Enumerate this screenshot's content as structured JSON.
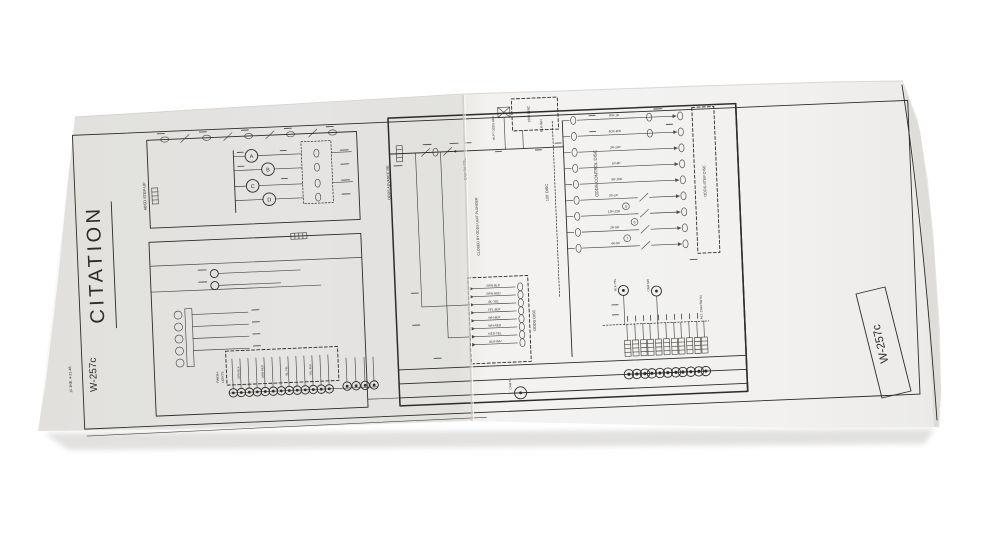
{
  "photo": {
    "background_color": "#ffffff",
    "paper_color": "#f1f0ee",
    "paper_shade_color": "#e7e5e2",
    "ink_color": "#2e2b28",
    "shadow_color": "#dddcda"
  },
  "document": {
    "title": "CITATION",
    "drawing_number": "W-257c",
    "margin_note": "10 3NB. 4-21-48"
  },
  "schematic": {
    "relay_labels": [
      "A",
      "B",
      "C",
      "D"
    ],
    "labels": {
      "abcd_step_up": "ABCD STEP-UP",
      "odds_advance_relay": "ODDS ADVANCE RE.",
      "cam_sw_fol": "CAM SW FOL.",
      "closed_by_plunger": "CLOSED BY ODDS UNIT PLUNGER",
      "hi_pt_odds_adj": "HI-PT ODDS ADJ.",
      "disc_1000": "1000 DISC",
      "disc_100": "100' DISC",
      "blk_wh": "BLK-WH",
      "odds_disc": "ODDS DISC",
      "odds_control_disc": "ODDS CONTROL DISC",
      "odds_step_disc": "ODDS-STEP DISC",
      "alt_cam_sw": "ALT. CAM SW #4",
      "cam_sw": "CAM SW",
      "blk_yel": "BLK-YEL",
      "cam_pl": "CAM P.L.",
      "finish_word": "FINISH",
      "lights_word": "LIGHTS"
    },
    "ladder_labels": [
      "WH-1R",
      "5CR-WH",
      "2R-12R",
      "1R-8F",
      "5R-15R",
      "2R-1R",
      "12R-22R",
      "2R-5R",
      "4R-5R"
    ],
    "wire_labels": [
      "GRN-BLK",
      "GRN-RED",
      "BL-YEL",
      "YEL-BLK",
      "WH-BLK",
      "WH-RED",
      "RED-YEL",
      "BLK-WH"
    ],
    "step_digits": [
      "5",
      "6",
      "7"
    ]
  }
}
